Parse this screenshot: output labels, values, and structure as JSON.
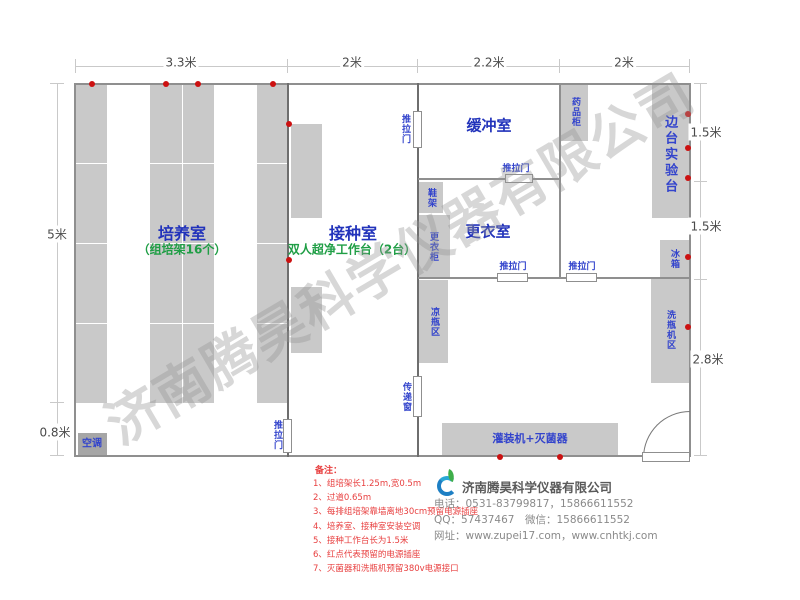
{
  "watermark": "济南腾昊科学仪器有限公司",
  "dimensions": {
    "top": [
      "3.3米",
      "2米",
      "2.2米",
      "2米"
    ],
    "left": [
      "5米",
      "0.8米"
    ],
    "right": [
      "1.5米",
      "1.5米",
      "2.8米"
    ]
  },
  "rooms": {
    "cultivation": {
      "name": "培养室",
      "sub": "（组培架16个）"
    },
    "inoculation": {
      "name": "接种室",
      "sub": "双人超净工作台（2台）"
    },
    "buffer": {
      "name": "缓冲室"
    },
    "changing": {
      "name": "更衣室"
    },
    "side_bench": {
      "name": "边台实验台"
    }
  },
  "fixtures": {
    "sliding_door": "推拉门",
    "transfer_window": "传递窗",
    "medicine_cabinet": "药品柜",
    "shoe_rack": "鞋架",
    "wardrobe": "更衣柜",
    "cooling_area": "凉瓶区",
    "fridge": "冰箱",
    "washer_area": "洗瓶机区",
    "filler_sterilizer": "灌装机+灭菌器",
    "air_conditioner": "空调"
  },
  "notes": {
    "title": "备注：",
    "items": [
      "1、组培架长1.25m,宽0.5m",
      "2、过道0.65m",
      "3、每排组培架靠墙离地30cm预留电源插座",
      "4、培养室、接种室安装空调",
      "5、接种工作台长为1.5米",
      "6、红点代表预留的电源插座",
      "7、灭菌器和洗瓶机预留380v电源接口"
    ]
  },
  "company": {
    "name": "济南腾昊科学仪器有限公司",
    "phone": "电话：0531-83799817，15866611552",
    "qq": "QQ：57437467　微信：15866611552",
    "web": "网址：www.zupei17.com，www.cnhtkj.com"
  },
  "colors": {
    "room_label_blue": "#2233bb",
    "sub_label_green": "#1f9e45",
    "note_red": "#e84040",
    "socket_dot_red": "#cc1111",
    "furniture_gray": "#c9c9c9",
    "wall_gray": "#8f8f8f"
  }
}
